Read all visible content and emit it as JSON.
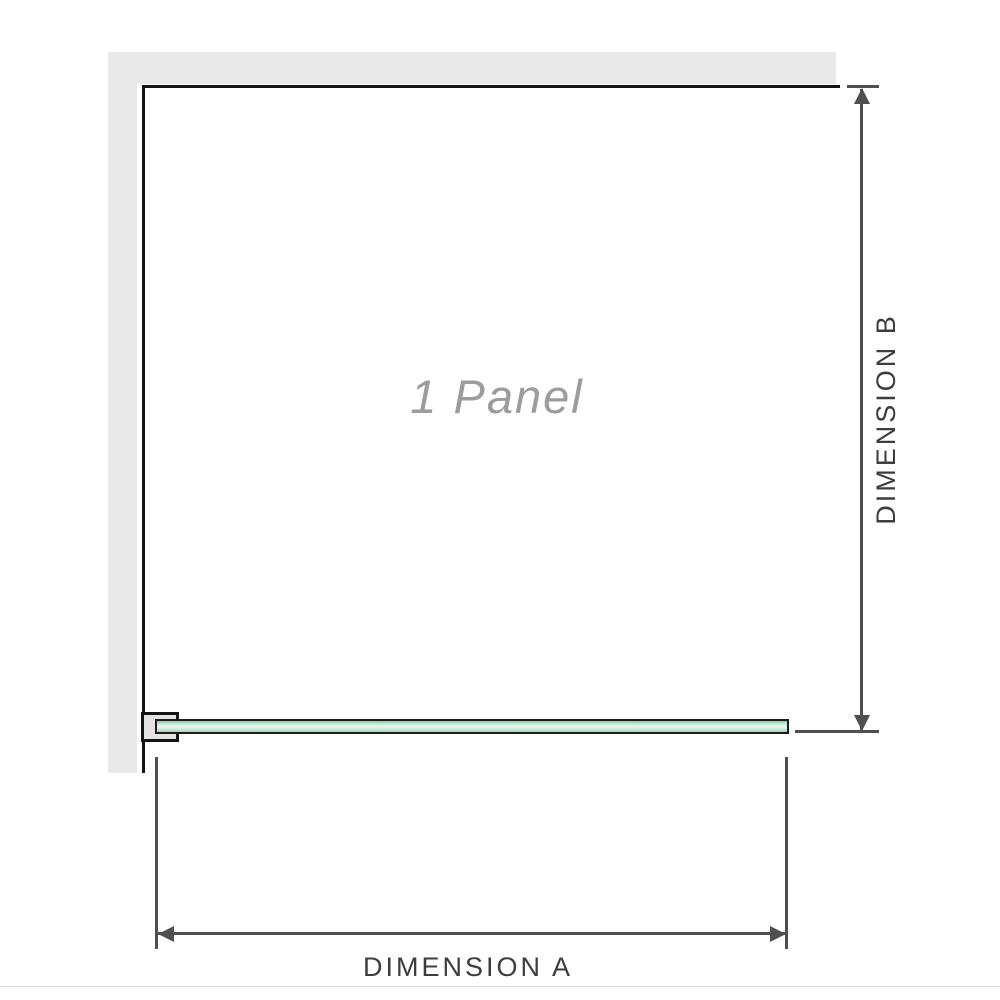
{
  "diagram": {
    "panel_label": "1 Panel",
    "dimension_a_label": "DIMENSION A",
    "dimension_b_label": "DIMENSION B"
  },
  "colors": {
    "wall": "#e9e9e9",
    "frame": "#141414",
    "bracket_fill": "#e3e3e3",
    "glass_border": "#1c1c1c",
    "glass_top": "#7fc8a1",
    "glass_mid": "#e9f6f0",
    "glass_bottom": "#9bd6b6",
    "dim_line": "#4f4f4f",
    "dim_text": "#3d3d3d",
    "panel_text": "#9c9c9c",
    "photo_edge": "#dcdcdc"
  }
}
